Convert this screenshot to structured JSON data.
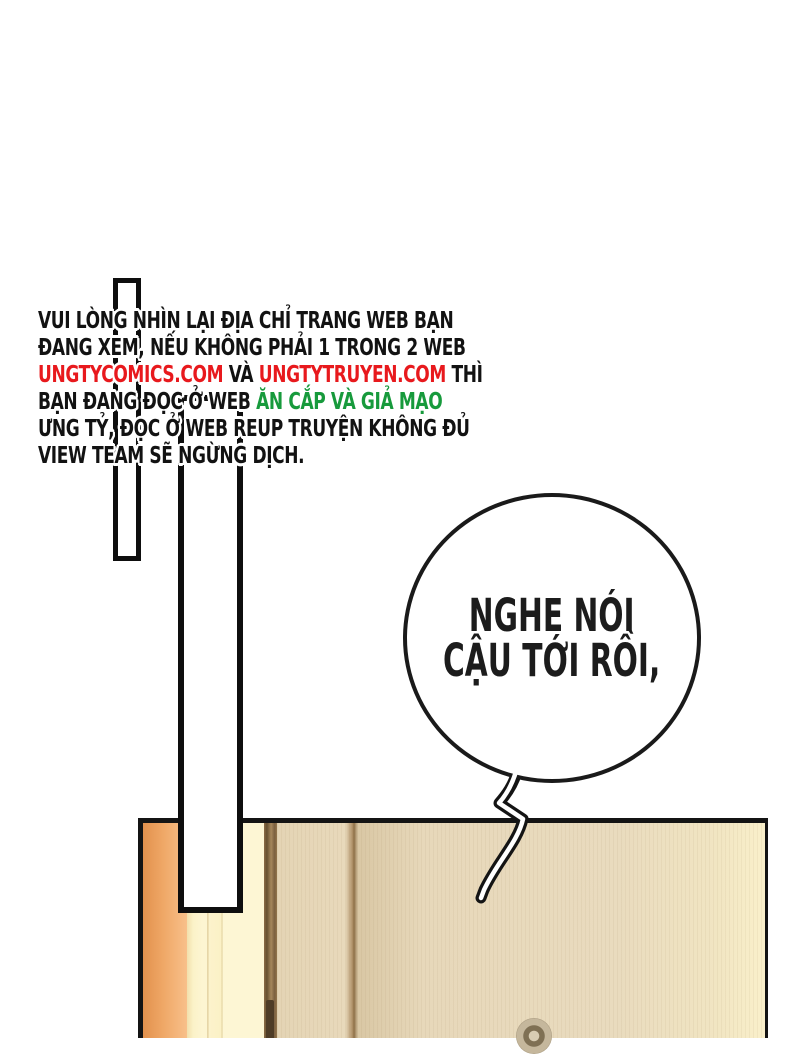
{
  "page": {
    "background_color": "#ffffff",
    "type": "comic-page"
  },
  "notice": {
    "palette": {
      "black": "#121212",
      "red": "#e8191d",
      "green": "#179a3c"
    },
    "lines": [
      [
        {
          "t": "VUI LÒNG NHÌN LẠI ĐỊA CHỈ TRANG WEB BẠN",
          "c": "black"
        }
      ],
      [
        {
          "t": "ĐANG XEM, NẾU KHÔNG PHẢI 1 TRONG 2 WEB",
          "c": "black"
        }
      ],
      [
        {
          "t": "UNGTYCOMICS.COM",
          "c": "red"
        },
        {
          "t": " VÀ ",
          "c": "black"
        },
        {
          "t": "UNGTYTRUYEN.COM",
          "c": "red"
        },
        {
          "t": " THÌ",
          "c": "black"
        }
      ],
      [
        {
          "t": "BẠN ĐANG ĐỌC Ở WEB ",
          "c": "black"
        },
        {
          "t": "ĂN CẮP VÀ GIẢ MẠO",
          "c": "green"
        }
      ],
      [
        {
          "t": "ƯNG TỶ, ĐỌC Ở WEB REUP TRUYỆN KHÔNG ĐỦ",
          "c": "black"
        }
      ],
      [
        {
          "t": "VIEW TEAM SẼ NGỪNG DỊCH.",
          "c": "black"
        }
      ]
    ]
  },
  "speech_bubble": {
    "line1": "NGHE NÓI",
    "line2": "CẬU TỚI RỒI,",
    "text_color": "#1c1c1c",
    "fill": "#ffffff",
    "stroke": "#1a1a1a"
  },
  "artwork": {
    "door": {
      "outline": "#141414",
      "frame_orange": [
        "#e2914d",
        "#f8c08a"
      ],
      "frame_cream": "#fdf5d2",
      "divider_brown": "#66502f",
      "panel_tan": "#e8d9bb",
      "panel_light_edge": "#f9efca",
      "seam_brown": "#8f7149",
      "knob_ring_light": "#c5b79c",
      "knob_ring_dark": "#7f7054",
      "knob_center": "#d8ccb3"
    },
    "panel_bars": {
      "fill": "#ffffff",
      "stroke": "#0e0e0e"
    }
  }
}
